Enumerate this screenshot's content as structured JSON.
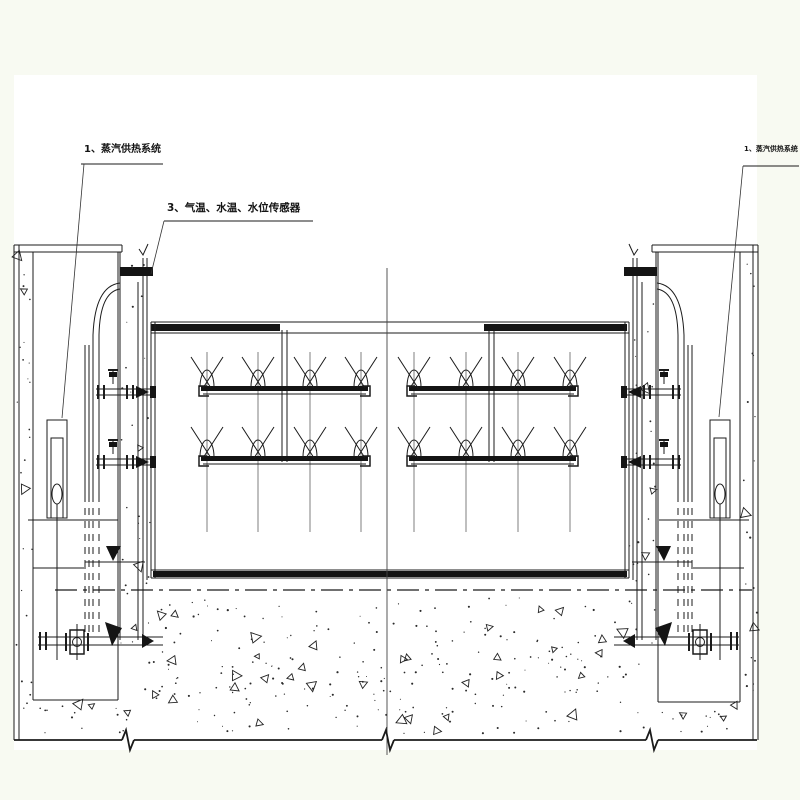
{
  "drawing": {
    "background_color": "#f8faf2",
    "paper_color": "#ffffff",
    "line_color": "#1b1b1b",
    "annotations": {
      "steam_left": "1、蒸汽供热系统",
      "sensors": "3、气温、水温、水位传感器",
      "steam_right": "1、蒸汽供热系统"
    }
  }
}
